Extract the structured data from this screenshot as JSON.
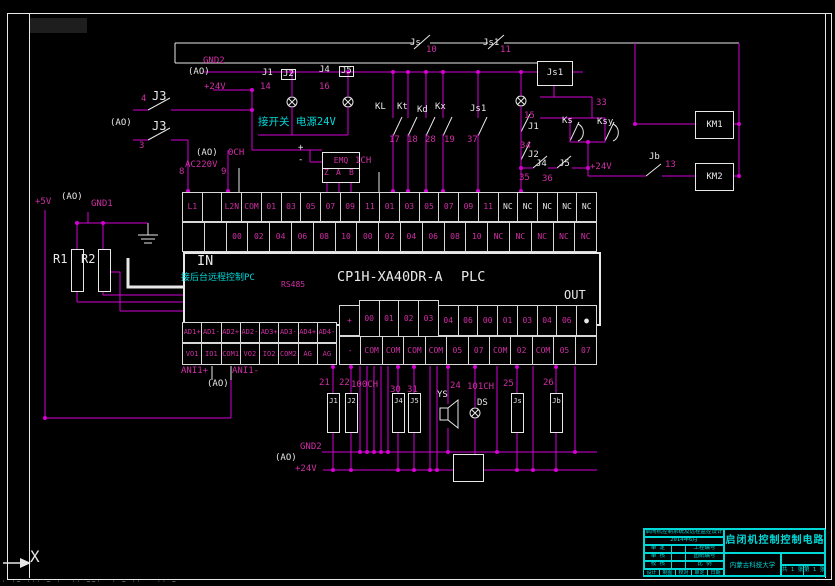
{
  "plc": {
    "in_label": "IN",
    "out_label": "OUT",
    "model": "CP1H-XA40DR-A",
    "type_label": "PLC"
  },
  "terminals": {
    "input_top": [
      "L1",
      "",
      "L2N",
      "COM",
      "01",
      "03",
      "05",
      "07",
      "09",
      "11",
      "01",
      "03",
      "05",
      "07",
      "09",
      "11",
      "NC",
      "NC",
      "NC",
      "NC",
      "NC"
    ],
    "input_bottom": [
      "",
      "",
      "00",
      "02",
      "04",
      "06",
      "08",
      "10",
      "00",
      "02",
      "04",
      "06",
      "08",
      "10",
      "NC",
      "NC",
      "NC",
      "NC",
      "NC"
    ],
    "analog_top": [
      "AD1+",
      "AD1-",
      "AD2+",
      "AD2-",
      "AD3+",
      "AD3-",
      "AD4+",
      "AD4-"
    ],
    "analog_bottom": [
      "VO1",
      "IO1",
      "COM1",
      "VO2",
      "IO2",
      "COM2",
      "AG",
      "AG"
    ],
    "output_top": [
      "+",
      "00",
      "01",
      "02",
      "03",
      "04",
      "06",
      "00",
      "01",
      "03",
      "04",
      "06",
      "●"
    ],
    "output_bottom": [
      "-",
      "COM",
      "COM",
      "COM",
      "COM",
      "05",
      "07",
      "COM",
      "02",
      "COM",
      "05",
      "07"
    ]
  },
  "boxes": {
    "js1_relay": "Js1",
    "km1": "KM1",
    "km2": "KM2",
    "emq": "EMQ"
  },
  "coils": [
    {
      "t": "J1",
      "x": 327
    },
    {
      "t": "J2",
      "x": 345
    },
    {
      "t": "J4",
      "x": 392
    },
    {
      "t": "J5",
      "x": 408
    },
    {
      "t": "Js",
      "x": 511
    },
    {
      "t": "Jb",
      "x": 550
    }
  ],
  "annotations": [
    {
      "n": "gnd2-top-label",
      "t": "GND2",
      "x": 203,
      "y": 57,
      "c": "m s9"
    },
    {
      "n": "ao-label-1",
      "t": "(AO)",
      "x": 188,
      "y": 68,
      "c": "w s9"
    },
    {
      "n": "p24v-top-label",
      "t": "+24V",
      "x": 204,
      "y": 83,
      "c": "m s9"
    },
    {
      "n": "j3-upper-label",
      "t": "J3",
      "x": 152,
      "y": 90,
      "c": "w s12"
    },
    {
      "n": "j3-lower-label",
      "t": "J3",
      "x": 152,
      "y": 120,
      "c": "w s12"
    },
    {
      "n": "wire-num-4",
      "t": "4",
      "x": 141,
      "y": 95,
      "c": "m s9"
    },
    {
      "n": "wire-num-3",
      "t": "3",
      "x": 139,
      "y": 142,
      "c": "m s9"
    },
    {
      "n": "ao-label-2",
      "t": "(AO)",
      "x": 110,
      "y": 119,
      "c": "w s9"
    },
    {
      "n": "ao-label-3",
      "t": "(AO)",
      "x": 196,
      "y": 149,
      "c": "w s9"
    },
    {
      "n": "ac220v-label",
      "t": "AC220V",
      "x": 185,
      "y": 161,
      "c": "m s9"
    },
    {
      "n": "wire-num-8",
      "t": "8",
      "x": 179,
      "y": 168,
      "c": "m s9"
    },
    {
      "n": "wire-num-9",
      "t": "9",
      "x": 221,
      "y": 168,
      "c": "m s9"
    },
    {
      "n": "och-label",
      "t": "0CH",
      "x": 228,
      "y": 149,
      "c": "m s9"
    },
    {
      "n": "j1-top-label",
      "t": "J1",
      "x": 262,
      "y": 69,
      "c": "w s9"
    },
    {
      "n": "j2-top-label",
      "t": "J2",
      "x": 281,
      "y": 69,
      "c": "w s9 bx"
    },
    {
      "n": "wire-num-14",
      "t": "14",
      "x": 260,
      "y": 83,
      "c": "m s9"
    },
    {
      "n": "j4-top-label",
      "t": "J4",
      "x": 319,
      "y": 66,
      "c": "w s9"
    },
    {
      "n": "j5-top-label",
      "t": "J5",
      "x": 339,
      "y": 66,
      "c": "w s9 bx"
    },
    {
      "n": "wire-num-16",
      "t": "16",
      "x": 319,
      "y": 83,
      "c": "m s9"
    },
    {
      "n": "switch-power-note",
      "t": "接开关 电源24V",
      "x": 258,
      "y": 117,
      "c": "cy s10"
    },
    {
      "n": "js-top-label",
      "t": "Js",
      "x": 410,
      "y": 39,
      "c": "w s9"
    },
    {
      "n": "wire-num-10",
      "t": "10",
      "x": 426,
      "y": 46,
      "c": "m s9"
    },
    {
      "n": "js1-top-label",
      "t": "Js1",
      "x": 483,
      "y": 39,
      "c": "w s9"
    },
    {
      "n": "wire-num-11",
      "t": "11",
      "x": 500,
      "y": 46,
      "c": "m s9"
    },
    {
      "n": "kl-label",
      "t": "KL",
      "x": 375,
      "y": 103,
      "c": "w s9"
    },
    {
      "n": "kt-label",
      "t": "Kt",
      "x": 397,
      "y": 103,
      "c": "w s9"
    },
    {
      "n": "kd-label",
      "t": "Kd",
      "x": 417,
      "y": 106,
      "c": "w s9"
    },
    {
      "n": "kx-label",
      "t": "Kx",
      "x": 435,
      "y": 103,
      "c": "w s9"
    },
    {
      "n": "js1-mid-label",
      "t": "Js1",
      "x": 470,
      "y": 105,
      "c": "w s9"
    },
    {
      "n": "wire-num-17",
      "t": "17",
      "x": 389,
      "y": 136,
      "c": "m s9"
    },
    {
      "n": "wire-num-18",
      "t": "18",
      "x": 407,
      "y": 136,
      "c": "m s9"
    },
    {
      "n": "wire-num-28",
      "t": "28",
      "x": 425,
      "y": 136,
      "c": "m s9"
    },
    {
      "n": "wire-num-19",
      "t": "19",
      "x": 444,
      "y": 136,
      "c": "m s9"
    },
    {
      "n": "wire-num-37",
      "t": "37",
      "x": 467,
      "y": 136,
      "c": "m s9"
    },
    {
      "n": "wire-num-15",
      "t": "15",
      "x": 524,
      "y": 112,
      "c": "m s9"
    },
    {
      "n": "j1-chain-label",
      "t": "J1",
      "x": 528,
      "y": 123,
      "c": "w s9"
    },
    {
      "n": "wire-num-34",
      "t": "34",
      "x": 520,
      "y": 142,
      "c": "m s9"
    },
    {
      "n": "j2-chain-label",
      "t": "J2",
      "x": 528,
      "y": 151,
      "c": "w s9"
    },
    {
      "n": "j4-chain-label",
      "t": "J4",
      "x": 536,
      "y": 160,
      "c": "w s9"
    },
    {
      "n": "j5-chain-label",
      "t": "J5",
      "x": 559,
      "y": 160,
      "c": "w s9"
    },
    {
      "n": "wire-num-35",
      "t": "35",
      "x": 519,
      "y": 174,
      "c": "m s9"
    },
    {
      "n": "wire-num-36",
      "t": "36",
      "x": 542,
      "y": 175,
      "c": "m s9"
    },
    {
      "n": "p24v-mid-label",
      "t": "+24V",
      "x": 590,
      "y": 163,
      "c": "m s9"
    },
    {
      "n": "wire-num-33",
      "t": "33",
      "x": 596,
      "y": 99,
      "c": "m s9"
    },
    {
      "n": "ks-label",
      "t": "Ks",
      "x": 562,
      "y": 117,
      "c": "w s9"
    },
    {
      "n": "ksy-label",
      "t": "Ksy",
      "x": 597,
      "y": 118,
      "c": "w s9"
    },
    {
      "n": "jb-label",
      "t": "Jb",
      "x": 649,
      "y": 153,
      "c": "w s9"
    },
    {
      "n": "wire-num-13",
      "t": "13",
      "x": 665,
      "y": 161,
      "c": "m s9"
    },
    {
      "n": "p5v-label",
      "t": "+5V",
      "x": 35,
      "y": 198,
      "c": "m s9"
    },
    {
      "n": "ao-label-4",
      "t": "(AO)",
      "x": 61,
      "y": 193,
      "c": "w s9"
    },
    {
      "n": "gnd1-label",
      "t": "GND1",
      "x": 91,
      "y": 200,
      "c": "m s9"
    },
    {
      "n": "r1-label",
      "t": "R1",
      "x": 53,
      "y": 253,
      "c": "w s12"
    },
    {
      "n": "r2-label",
      "t": "R2",
      "x": 81,
      "y": 253,
      "c": "w s12"
    },
    {
      "n": "remote-pc-note",
      "t": "接后台远程控制PC",
      "x": 181,
      "y": 274,
      "c": "cy s9"
    },
    {
      "n": "rs485-label",
      "t": "RS485",
      "x": 281,
      "y": 281,
      "c": "m s8"
    },
    {
      "n": "emq-plus",
      "t": "+",
      "x": 298,
      "y": 144,
      "c": "w s9"
    },
    {
      "n": "emq-minus",
      "t": "-",
      "x": 298,
      "y": 156,
      "c": "w s9"
    },
    {
      "n": "emq-z",
      "t": "Z",
      "x": 324,
      "y": 169,
      "c": "m s8"
    },
    {
      "n": "emq-a",
      "t": "A",
      "x": 336,
      "y": 169,
      "c": "m s8"
    },
    {
      "n": "emq-b",
      "t": "B",
      "x": 349,
      "y": 169,
      "c": "m s8"
    },
    {
      "n": "1ch-label",
      "t": "1CH",
      "x": 355,
      "y": 157,
      "c": "m s9"
    },
    {
      "n": "ani-plus-label",
      "t": "ANI1+",
      "x": 181,
      "y": 367,
      "c": "m s9"
    },
    {
      "n": "ani-minus-label",
      "t": "ANI1-",
      "x": 232,
      "y": 367,
      "c": "m s9"
    },
    {
      "n": "ao-label-5",
      "t": "(AO)",
      "x": 207,
      "y": 380,
      "c": "w s9"
    },
    {
      "n": "wire-num-21",
      "t": "21",
      "x": 319,
      "y": 379,
      "c": "m s9"
    },
    {
      "n": "wire-num-22",
      "t": "22",
      "x": 339,
      "y": 379,
      "c": "m s9"
    },
    {
      "n": "100ch-label",
      "t": "100CH",
      "x": 351,
      "y": 381,
      "c": "m s9"
    },
    {
      "n": "wire-num-30",
      "t": "30",
      "x": 390,
      "y": 386,
      "c": "m s9"
    },
    {
      "n": "wire-num-31",
      "t": "31",
      "x": 407,
      "y": 386,
      "c": "m s9"
    },
    {
      "n": "wire-num-24",
      "t": "24",
      "x": 450,
      "y": 382,
      "c": "m s9"
    },
    {
      "n": "101ch-label",
      "t": "101CH",
      "x": 467,
      "y": 383,
      "c": "m s9"
    },
    {
      "n": "wire-num-25",
      "t": "25",
      "x": 503,
      "y": 380,
      "c": "m s9"
    },
    {
      "n": "wire-num-26",
      "t": "26",
      "x": 543,
      "y": 379,
      "c": "m s9"
    },
    {
      "n": "ys-label",
      "t": "YS",
      "x": 437,
      "y": 391,
      "c": "w s9"
    },
    {
      "n": "ds-label",
      "t": "DS",
      "x": 477,
      "y": 399,
      "c": "w s9"
    },
    {
      "n": "gnd2-bottom-label",
      "t": "GND2",
      "x": 300,
      "y": 443,
      "c": "m s9"
    },
    {
      "n": "ao-label-6",
      "t": "(AO)",
      "x": 275,
      "y": 454,
      "c": "w s9"
    },
    {
      "n": "p24v-bottom-label",
      "t": "+24V",
      "x": 295,
      "y": 465,
      "c": "m s9"
    },
    {
      "n": "ucs-x-label",
      "t": "X",
      "x": 30,
      "y": 549,
      "c": "w s15"
    }
  ],
  "title_block": {
    "line1": "启闭机控制系统及远程监控设计",
    "line2": "2014年6月",
    "rows": [
      {
        "l": "审 定",
        "m": "工程编号"
      },
      {
        "l": "审 核",
        "m": "图纸编号"
      },
      {
        "l": "校 核",
        "m": "比 例"
      }
    ],
    "bottom": [
      "设计",
      "制图",
      "校对",
      "审定",
      "日期"
    ],
    "title": "启闭机控制控制电路",
    "org": "内蒙古科技大学",
    "sheet_total": "共 1 张",
    "sheet_no": "第 1 张"
  },
  "status_line": "· ·─ ··· ─ ·  ·· ──·  · ─ ··   ·· ─",
  "colors": {
    "wire_magenta": "#d400d4",
    "text_magenta": "#cf2fa5",
    "cad_white": "#e8e8e8",
    "annotation_cyan": "#00d8d8",
    "background": "#000000"
  }
}
